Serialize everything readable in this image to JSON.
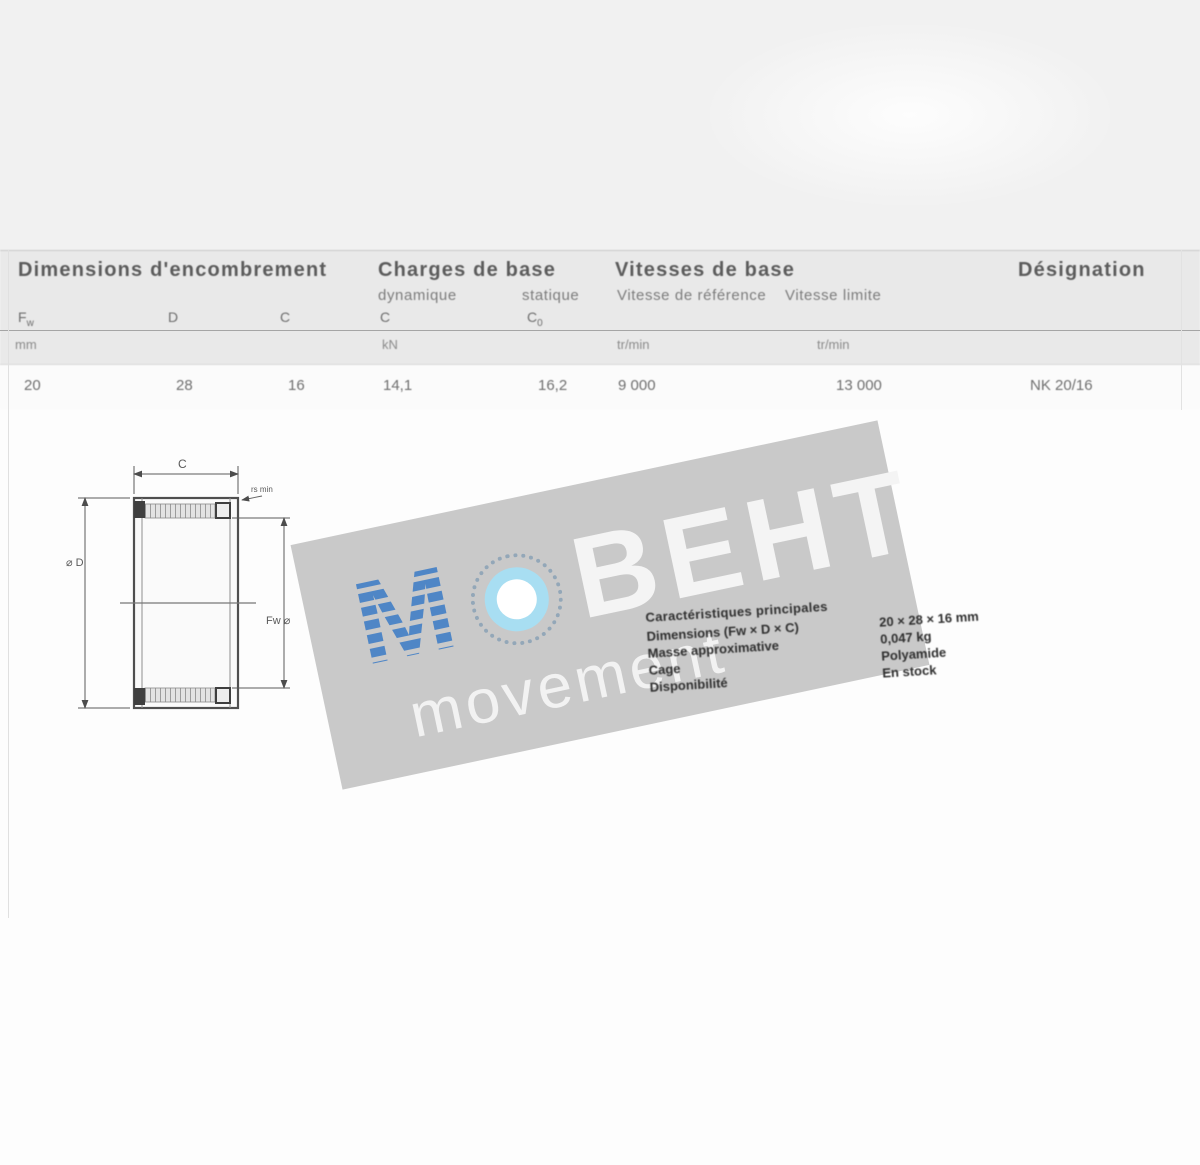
{
  "colors": {
    "accent_blue": "#4f86c6",
    "light_blue": "#a8def2",
    "band_gray": "#c9c9c9",
    "header_band": "#e9e9e9"
  },
  "table": {
    "group_dimensions": "Dimensions d'encombrement",
    "group_loads": "Charges de base",
    "group_speeds": "Vitesses de base",
    "group_designation": "Désignation",
    "sub_dynamic": "dynamique",
    "sub_static": "statique",
    "sub_speed_ref": "Vitesse de référence",
    "sub_speed_lim": "Vitesse limite",
    "symbols": {
      "fw_base": "F",
      "fw_sub": "w",
      "d": "D",
      "c": "C",
      "c_dyn": "C",
      "c_stat_base": "C",
      "c_stat_sub": "0"
    },
    "units": {
      "dim": "mm",
      "load": "kN",
      "speed_ref": "tr/min",
      "speed_lim": "tr/min"
    },
    "row": {
      "fw": "20",
      "d": "28",
      "c": "16",
      "c_dyn": "14,1",
      "c_stat": "16,2",
      "v_ref": "9 000",
      "v_lim": "13 000",
      "designation": "NK 20/16"
    }
  },
  "drawing": {
    "dim_width": "C",
    "dim_chamfer": "rs min",
    "dim_outer": "⌀ D",
    "dim_bore": "Fw ⌀"
  },
  "watermark": {
    "m": "М",
    "word": "ВЕНТ",
    "sub": "movement"
  },
  "details": {
    "heading": "Caractéristiques principales",
    "rows": [
      {
        "label": "Dimensions (Fw × D × C)",
        "value": "20 × 28 × 16 mm"
      },
      {
        "label": "Masse approximative",
        "value": "0,047 kg"
      },
      {
        "label": "Cage",
        "value": "Polyamide"
      },
      {
        "label": "Disponibilité",
        "value": "En stock"
      }
    ]
  }
}
